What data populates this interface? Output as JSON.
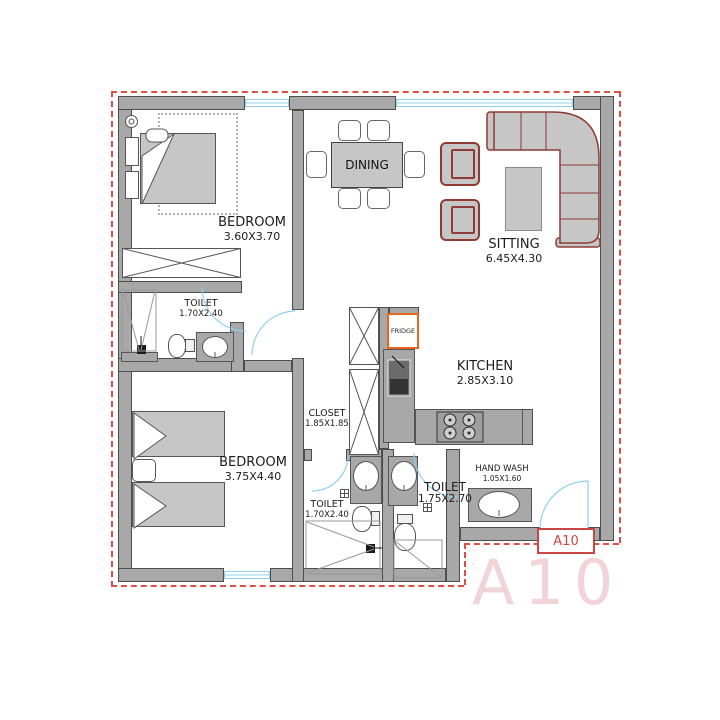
{
  "colors": {
    "wall": "#a8a8a8",
    "wall_edge": "#4d4d4d",
    "furniture": "#c6c6c6",
    "sofa_outline": "#8e3b34",
    "door_window_blue": "#8fd0ea",
    "boundary_dash_red": "#dd4f42",
    "fridge_outline_orange": "#e8661c",
    "label_text": "#1c1c1c",
    "unit_tag_red": "#cc4444",
    "watermark_pink": "#f2d4d8"
  },
  "rooms": {
    "bedroom1": {
      "name": "BEDROOM",
      "dims": "3.60X3.70"
    },
    "dining": {
      "name": "DINING"
    },
    "sitting": {
      "name": "SITTING",
      "dims": "6.45X4.30"
    },
    "toilet1": {
      "name": "TOILET",
      "dims": "1.70X2.40"
    },
    "closet": {
      "name": "CLOSET",
      "dims": "1.85X1.85"
    },
    "kitchen": {
      "name": "KITCHEN",
      "dims": "2.85X3.10"
    },
    "bedroom2": {
      "name": "BEDROOM",
      "dims": "3.75X4.40"
    },
    "toilet2": {
      "name": "TOILET",
      "dims": "1.70X2.40"
    },
    "toilet3": {
      "name": "TOILET",
      "dims": "1.75X2.70"
    },
    "handwash": {
      "name": "HAND WASH",
      "dims": "1.05X1.60"
    }
  },
  "appliances": {
    "fridge": "FRIDGE"
  },
  "unit": {
    "door_tag": "A10",
    "watermark": "A10"
  }
}
